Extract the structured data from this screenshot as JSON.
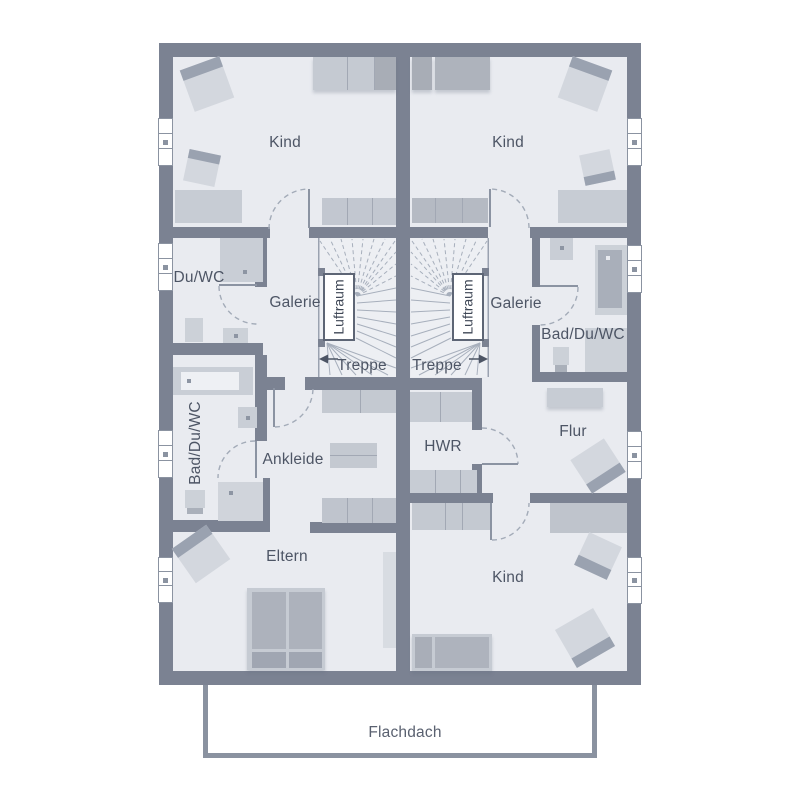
{
  "rooms": {
    "kind_top_left": "Kind",
    "kind_top_right": "Kind",
    "kind_bottom": "Kind",
    "du_wc": "Du/WC",
    "galerie_left": "Galerie",
    "galerie_right": "Galerie",
    "luftraum_left": "Luftraum",
    "luftraum_right": "Luftraum",
    "treppe_left": "Treppe",
    "treppe_right": "Treppe",
    "bad_du_wc_left": "Bad/Du/WC",
    "bad_du_wc_right": "Bad/Du/WC",
    "ankleide": "Ankleide",
    "hwr": "HWR",
    "flur": "Flur",
    "eltern": "Eltern"
  },
  "annotations": {
    "flachdach": "Flachdach"
  },
  "colors": {
    "wall": "#7b8292",
    "floor": "#e9ebf0",
    "furniture_light": "#c7ccd4",
    "furniture_medium": "#a9aeb8",
    "furniture_dark": "#9aa2b0",
    "door_line": "#a3abb8",
    "label_text": "#4d5565",
    "window": "#ffffff",
    "luftraum_border": "#5d6575",
    "background": "#ffffff"
  }
}
